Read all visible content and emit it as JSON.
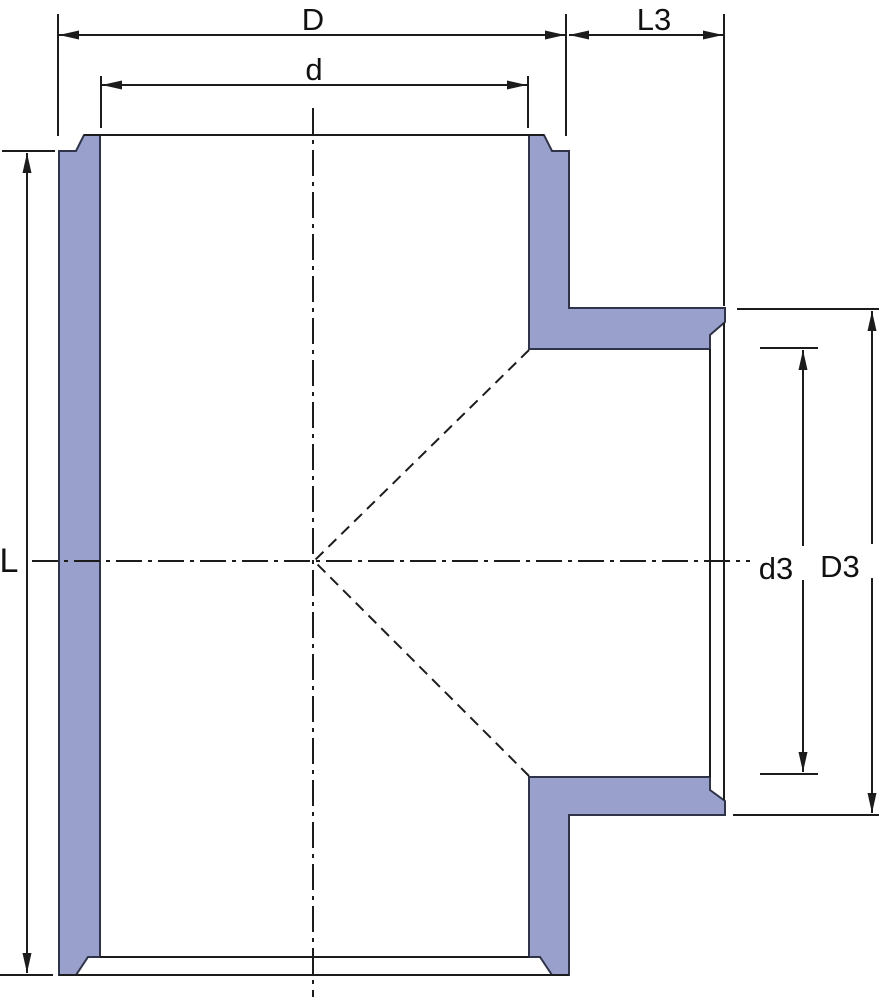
{
  "title": "Pipe tee fitting cross-section drawing",
  "drawing": {
    "dimensions": {
      "D": {
        "label": "D"
      },
      "d": {
        "label": "d"
      },
      "L3": {
        "label": "L3"
      },
      "L": {
        "label": "L"
      },
      "d3": {
        "label": "d3"
      },
      "D3": {
        "label": "D3"
      }
    },
    "colors": {
      "wall_fill": "#99a0cb",
      "wall_outline": "#30344a",
      "line": "#1c1c1c",
      "background": "#ffffff"
    }
  }
}
